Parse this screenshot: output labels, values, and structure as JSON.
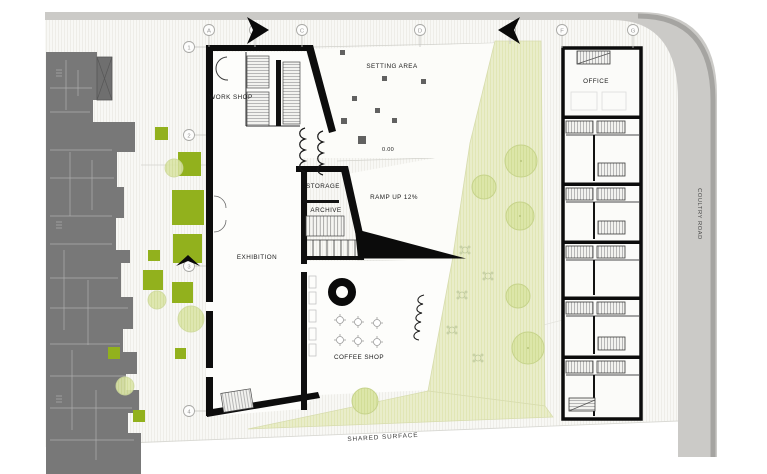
{
  "drawing": {
    "labels": {
      "workshop": "WORK SHOP",
      "setting_area": "SETTING AREA",
      "level": "0.00",
      "storage": "STORAGE",
      "archive": "ARCHIVE",
      "ramp": "RAMP UP 12%",
      "exhibition": "EXHIBITION",
      "coffee_shop": "COFFEE SHOP",
      "office": "OFFICE",
      "shared_surface": "SHARED SURFACE",
      "road": "COULTRY ROAD"
    },
    "grid": {
      "columns": [
        "A",
        "B",
        "C",
        "D",
        "E",
        "F",
        "G"
      ],
      "rows": [
        "1",
        "2",
        "3",
        "4"
      ]
    },
    "colors": {
      "planter_green": "#92b11d",
      "tree_fill": "#dce6a9",
      "lawn_fill": "#e9edca",
      "road_gray": "#cbcac7",
      "existing_building_gray": "#787878",
      "wall_black": "#0d0d0d"
    }
  }
}
